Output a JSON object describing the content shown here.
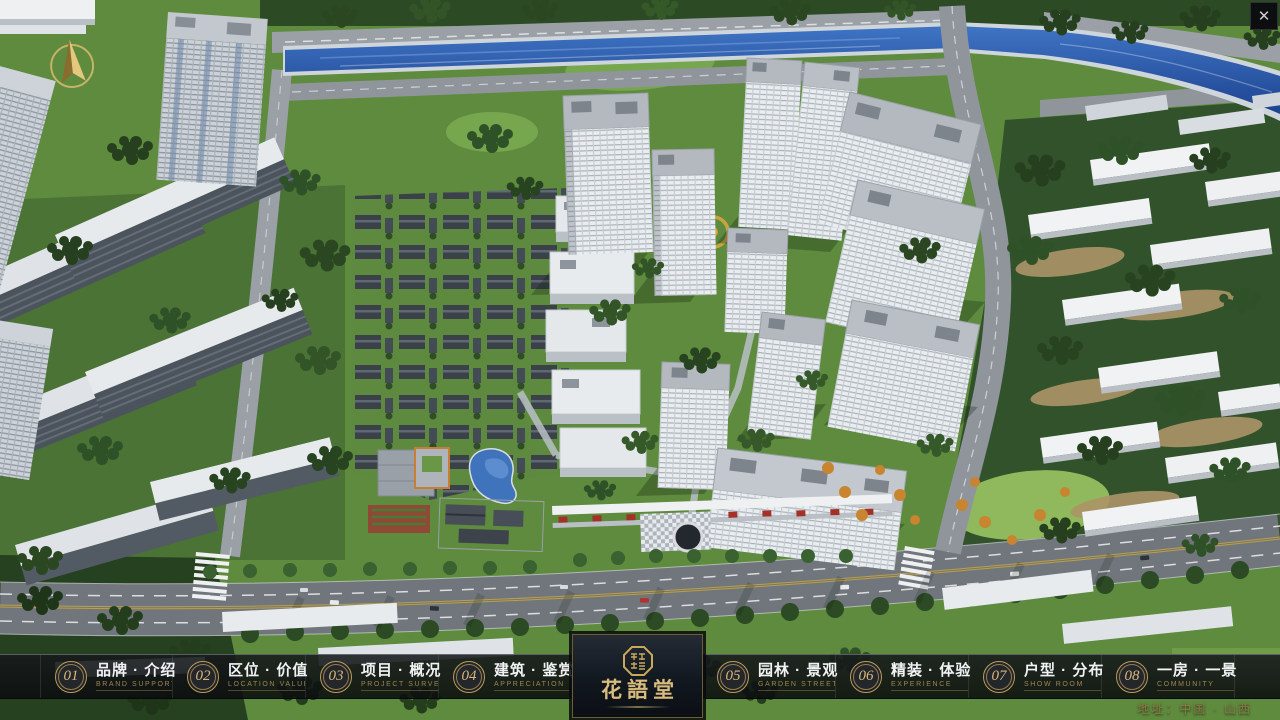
{
  "app": {
    "close_glyph": "✕"
  },
  "nav": {
    "items": [
      {
        "num": "01",
        "label": "品牌 · 介绍",
        "sub": "BRAND SUPPORT"
      },
      {
        "num": "02",
        "label": "区位 · 价值",
        "sub": "LOCATION VALUE"
      },
      {
        "num": "03",
        "label": "项目 · 概况",
        "sub": "PROJECT SURVEY"
      },
      {
        "num": "04",
        "label": "建筑 · 鉴赏",
        "sub": "APPRECIATION"
      },
      {
        "num": "05",
        "label": "园林 · 景观",
        "sub": "GARDEN STREET"
      },
      {
        "num": "06",
        "label": "精装 · 体验",
        "sub": "EXPERIENCE"
      },
      {
        "num": "07",
        "label": "户型 · 分布",
        "sub": "SHOW ROOM"
      },
      {
        "num": "08",
        "label": "一房 · 一景",
        "sub": "COMMUNITY"
      }
    ]
  },
  "logo": {
    "title": "花語堂"
  },
  "footer": {
    "address": "地址：中国 · 山西"
  },
  "colors": {
    "gold_accent": "#c9a85c",
    "nav_background": "#101214",
    "logo_panel": "#121820",
    "river_water": "#2b5ea6",
    "label_text": "#f0f2f3",
    "sub_text": "#9d8551"
  }
}
